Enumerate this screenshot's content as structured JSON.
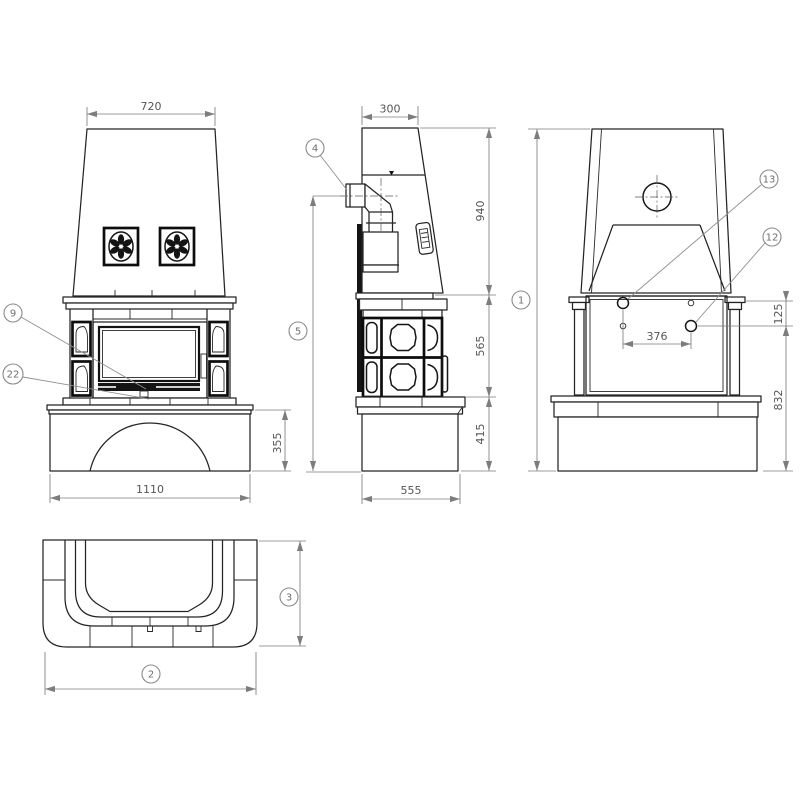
{
  "drawing": {
    "type": "fireplace-orthographic-views",
    "colors": {
      "line": "#242424",
      "dimension": "#7d7d7d",
      "background": "#ffffff"
    }
  },
  "dims": {
    "hood_top_width": "720",
    "base_width": "1110",
    "base_height": "355",
    "hood_top_depth": "300",
    "hood_height": "940",
    "body_height": "565",
    "plinth_height": "415",
    "base_depth": "555",
    "outlet_spacing": "376",
    "outlet_offset": "125",
    "outlet_floor_height": "832"
  },
  "callouts": {
    "c1": "1",
    "c2": "2",
    "c3": "3",
    "c4": "4",
    "c5": "5",
    "c9": "9",
    "c12": "12",
    "c13": "13",
    "c22": "22"
  }
}
